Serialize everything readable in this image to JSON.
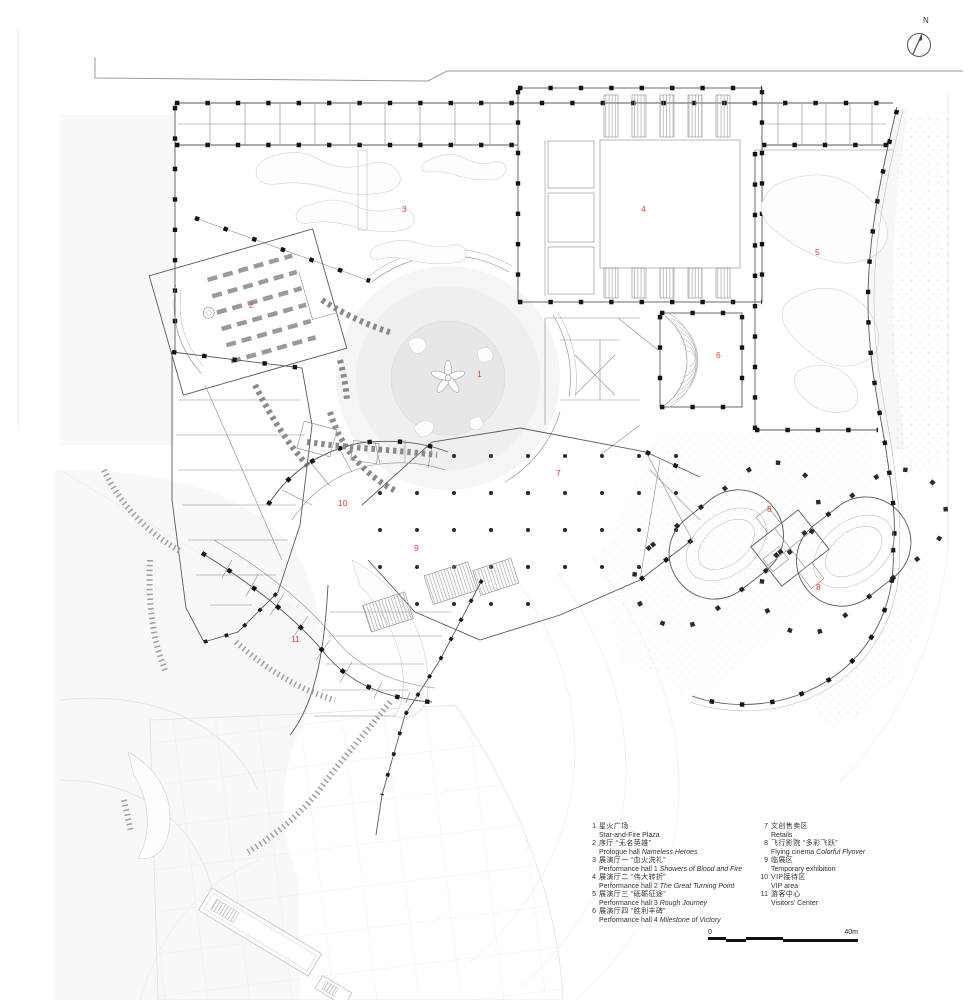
{
  "plan": {
    "label_color": "#e8402c",
    "labels": [
      {
        "n": "1",
        "x": 477,
        "y": 377
      },
      {
        "n": "2",
        "x": 249,
        "y": 308
      },
      {
        "n": "3",
        "x": 402,
        "y": 212
      },
      {
        "n": "4",
        "x": 641,
        "y": 212
      },
      {
        "n": "5",
        "x": 815,
        "y": 255
      },
      {
        "n": "6",
        "x": 716,
        "y": 358
      },
      {
        "n": "7",
        "x": 556,
        "y": 476
      },
      {
        "n": "8",
        "x": 767,
        "y": 512
      },
      {
        "n": "8",
        "x": 816,
        "y": 590
      },
      {
        "n": "9",
        "x": 414,
        "y": 551
      },
      {
        "n": "10",
        "x": 338,
        "y": 506
      },
      {
        "n": "11",
        "x": 291,
        "y": 642
      }
    ]
  },
  "north": {
    "label": "N"
  },
  "scalebar": {
    "start_label": "0",
    "end_label": "40m",
    "segments": [
      {
        "from": 0,
        "to": 0.12,
        "row": "top"
      },
      {
        "from": 0.12,
        "to": 0.25,
        "row": "bottom"
      },
      {
        "from": 0.25,
        "to": 0.5,
        "row": "top"
      },
      {
        "from": 0.5,
        "to": 1,
        "row": "bottom"
      }
    ]
  },
  "legend": {
    "columns": [
      {
        "items": [
          {
            "num": "1",
            "zh": "星火广场",
            "en": [
              {
                "text": "Star-and-Fire Plaza",
                "italic": false
              }
            ]
          },
          {
            "num": "2",
            "zh": "序厅 “无名英雄”",
            "en": [
              {
                "text": "Prologue hall ",
                "italic": false
              },
              {
                "text": "Nameless Heroes",
                "italic": true
              }
            ]
          },
          {
            "num": "3",
            "zh": "展演厅一 “血火洗礼”",
            "en": [
              {
                "text": "Performance hall 1 ",
                "italic": false
              },
              {
                "text": "Showers of Blood and Fire",
                "italic": true
              }
            ]
          },
          {
            "num": "4",
            "zh": "展演厅二 “伟大转折”",
            "en": [
              {
                "text": "Performance hall 2 ",
                "italic": false
              },
              {
                "text": "The Great Turning Point",
                "italic": true
              }
            ]
          },
          {
            "num": "5",
            "zh": "展演厅三 “砥砺征途”",
            "en": [
              {
                "text": "Performance hall 3 ",
                "italic": false
              },
              {
                "text": "Rough Journey",
                "italic": true
              }
            ]
          },
          {
            "num": "6",
            "zh": "展演厅四 “胜利丰碑”",
            "en": [
              {
                "text": "Performance hall 4 ",
                "italic": false
              },
              {
                "text": "Milestone of Victory",
                "italic": true
              }
            ]
          }
        ]
      },
      {
        "items": [
          {
            "num": "7",
            "zh": "文创售卖区",
            "en": [
              {
                "text": "Retails",
                "italic": false
              }
            ]
          },
          {
            "num": "8",
            "zh": "飞行影院 “多彩飞跃”",
            "en": [
              {
                "text": "Flying cinema ",
                "italic": false
              },
              {
                "text": "Colorful Flyover",
                "italic": true
              }
            ]
          },
          {
            "num": "9",
            "zh": "临展区",
            "en": [
              {
                "text": "Temporary exhibition",
                "italic": false
              }
            ]
          },
          {
            "num": "10",
            "zh": "VIP接待区",
            "en": [
              {
                "text": "VIP area",
                "italic": false
              }
            ]
          },
          {
            "num": "11",
            "zh": "游客中心",
            "en": [
              {
                "text": "Visitors' Center",
                "italic": false
              }
            ]
          }
        ]
      }
    ]
  }
}
